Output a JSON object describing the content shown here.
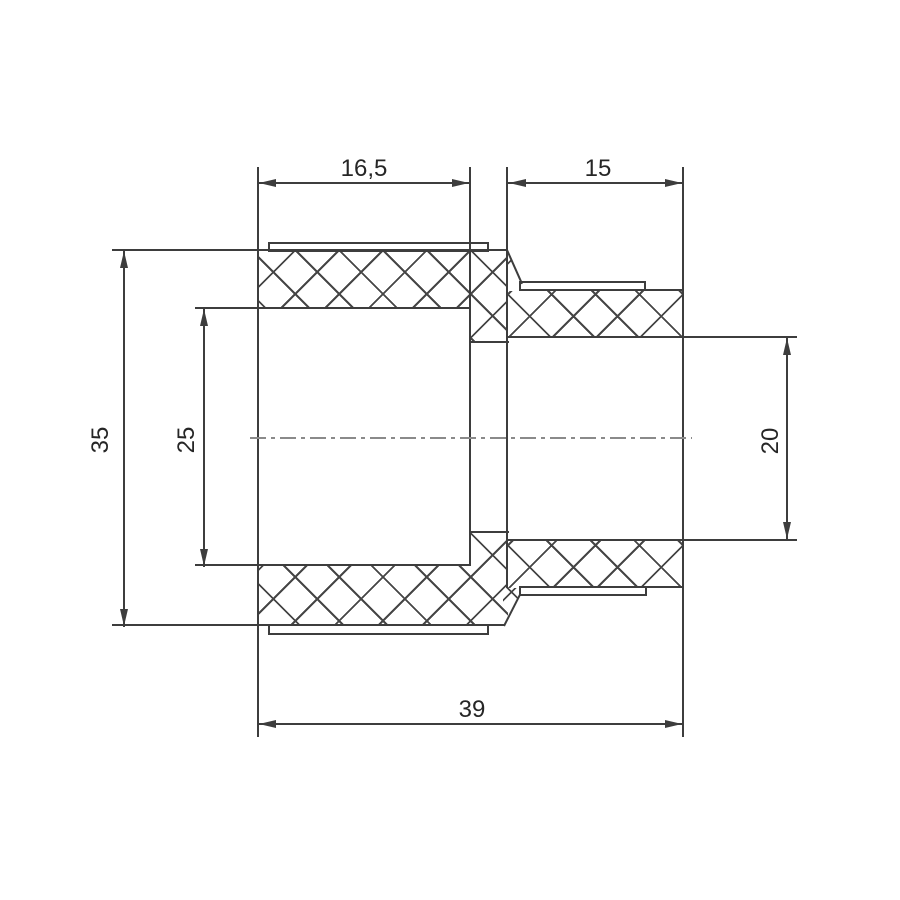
{
  "drawing": {
    "kind": "technical-section-drawing",
    "subject": "reducing coupling fitting cross-section",
    "line_color": "#3d3d3d",
    "centerline_color": "#8a8a8a",
    "background_color": "#ffffff",
    "dims": {
      "left_socket_depth": "16,5",
      "right_socket_depth": "15",
      "left_outer_height": "35",
      "left_inner_diameter": "25",
      "right_inner_diameter": "20",
      "overall_length": "39"
    }
  }
}
